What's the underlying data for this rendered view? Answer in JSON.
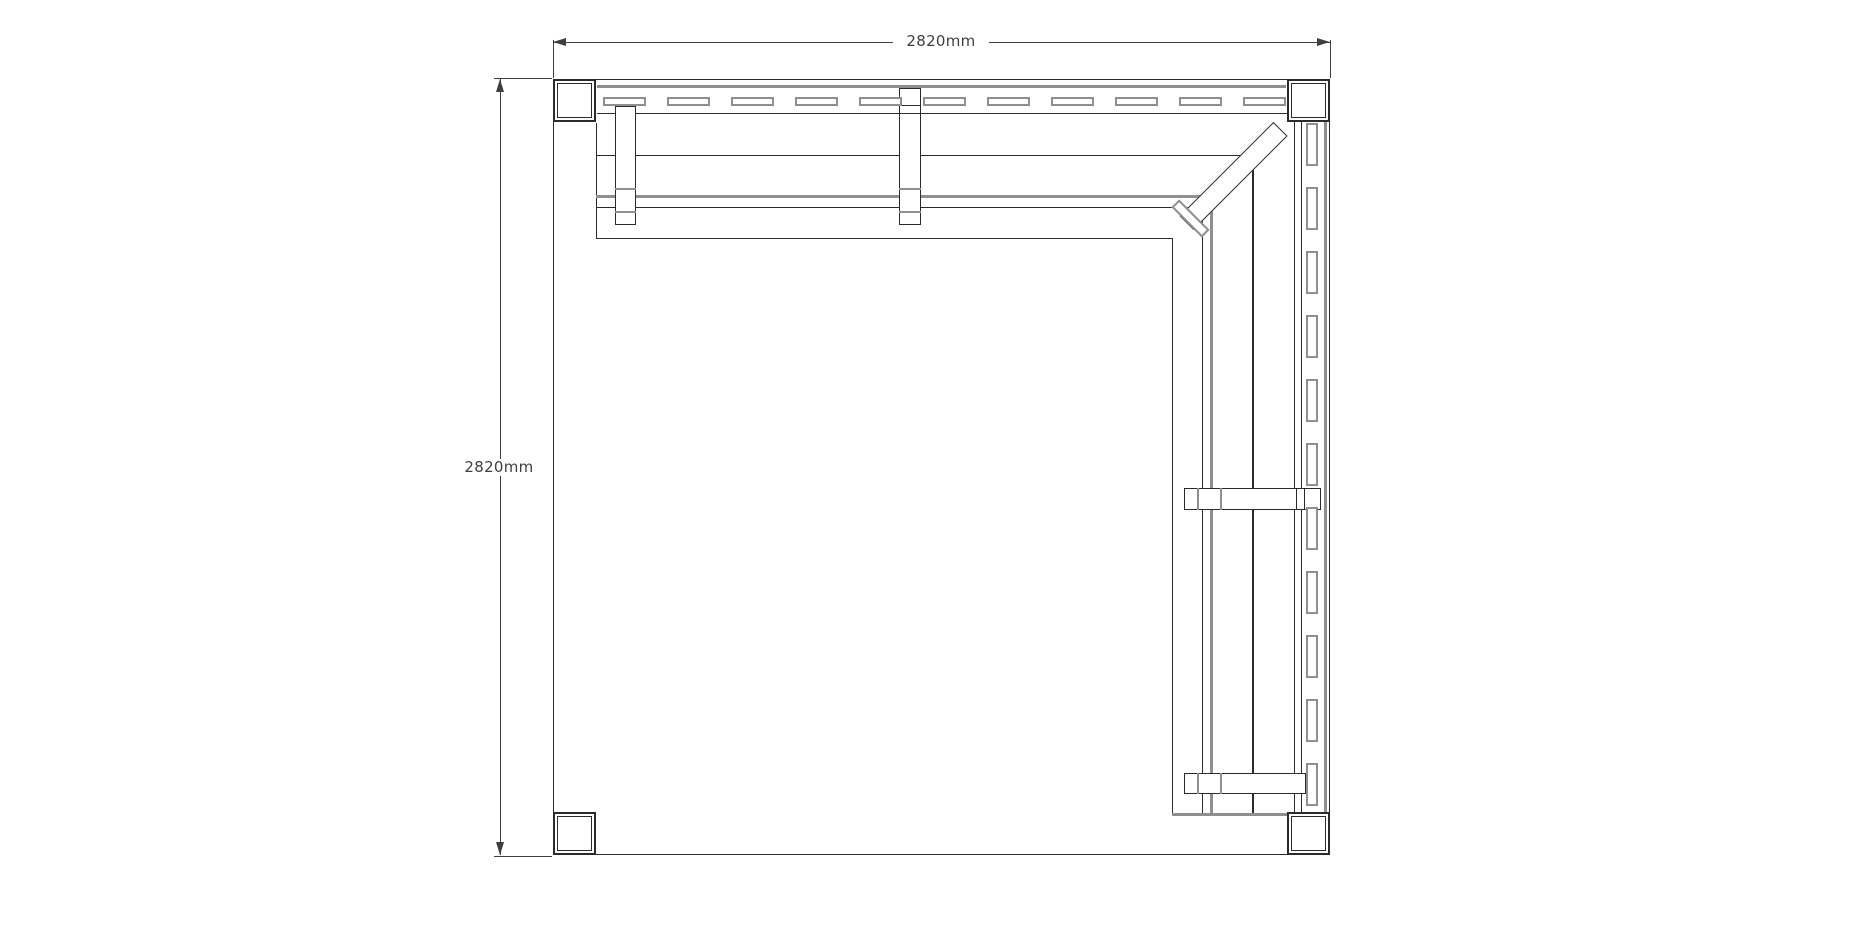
{
  "page": {
    "background": "#ffffff",
    "description_visible_text_only": true
  },
  "dimensions": {
    "top": {
      "label": "2820mm"
    },
    "left": {
      "label": "2820mm"
    }
  },
  "colors": {
    "line": "#2b2b2b",
    "secondary_line": "#8f8f8f",
    "dimension": "#3f3f3f",
    "background": "#ffffff"
  },
  "drawing": {
    "kind": "plan-view-technical-drawing",
    "outline": "square frame with four corner posts",
    "features": [
      "top bench with slatted back",
      "right bench with slatted back",
      "diagonal corner leg",
      "bench legs with caps"
    ]
  }
}
